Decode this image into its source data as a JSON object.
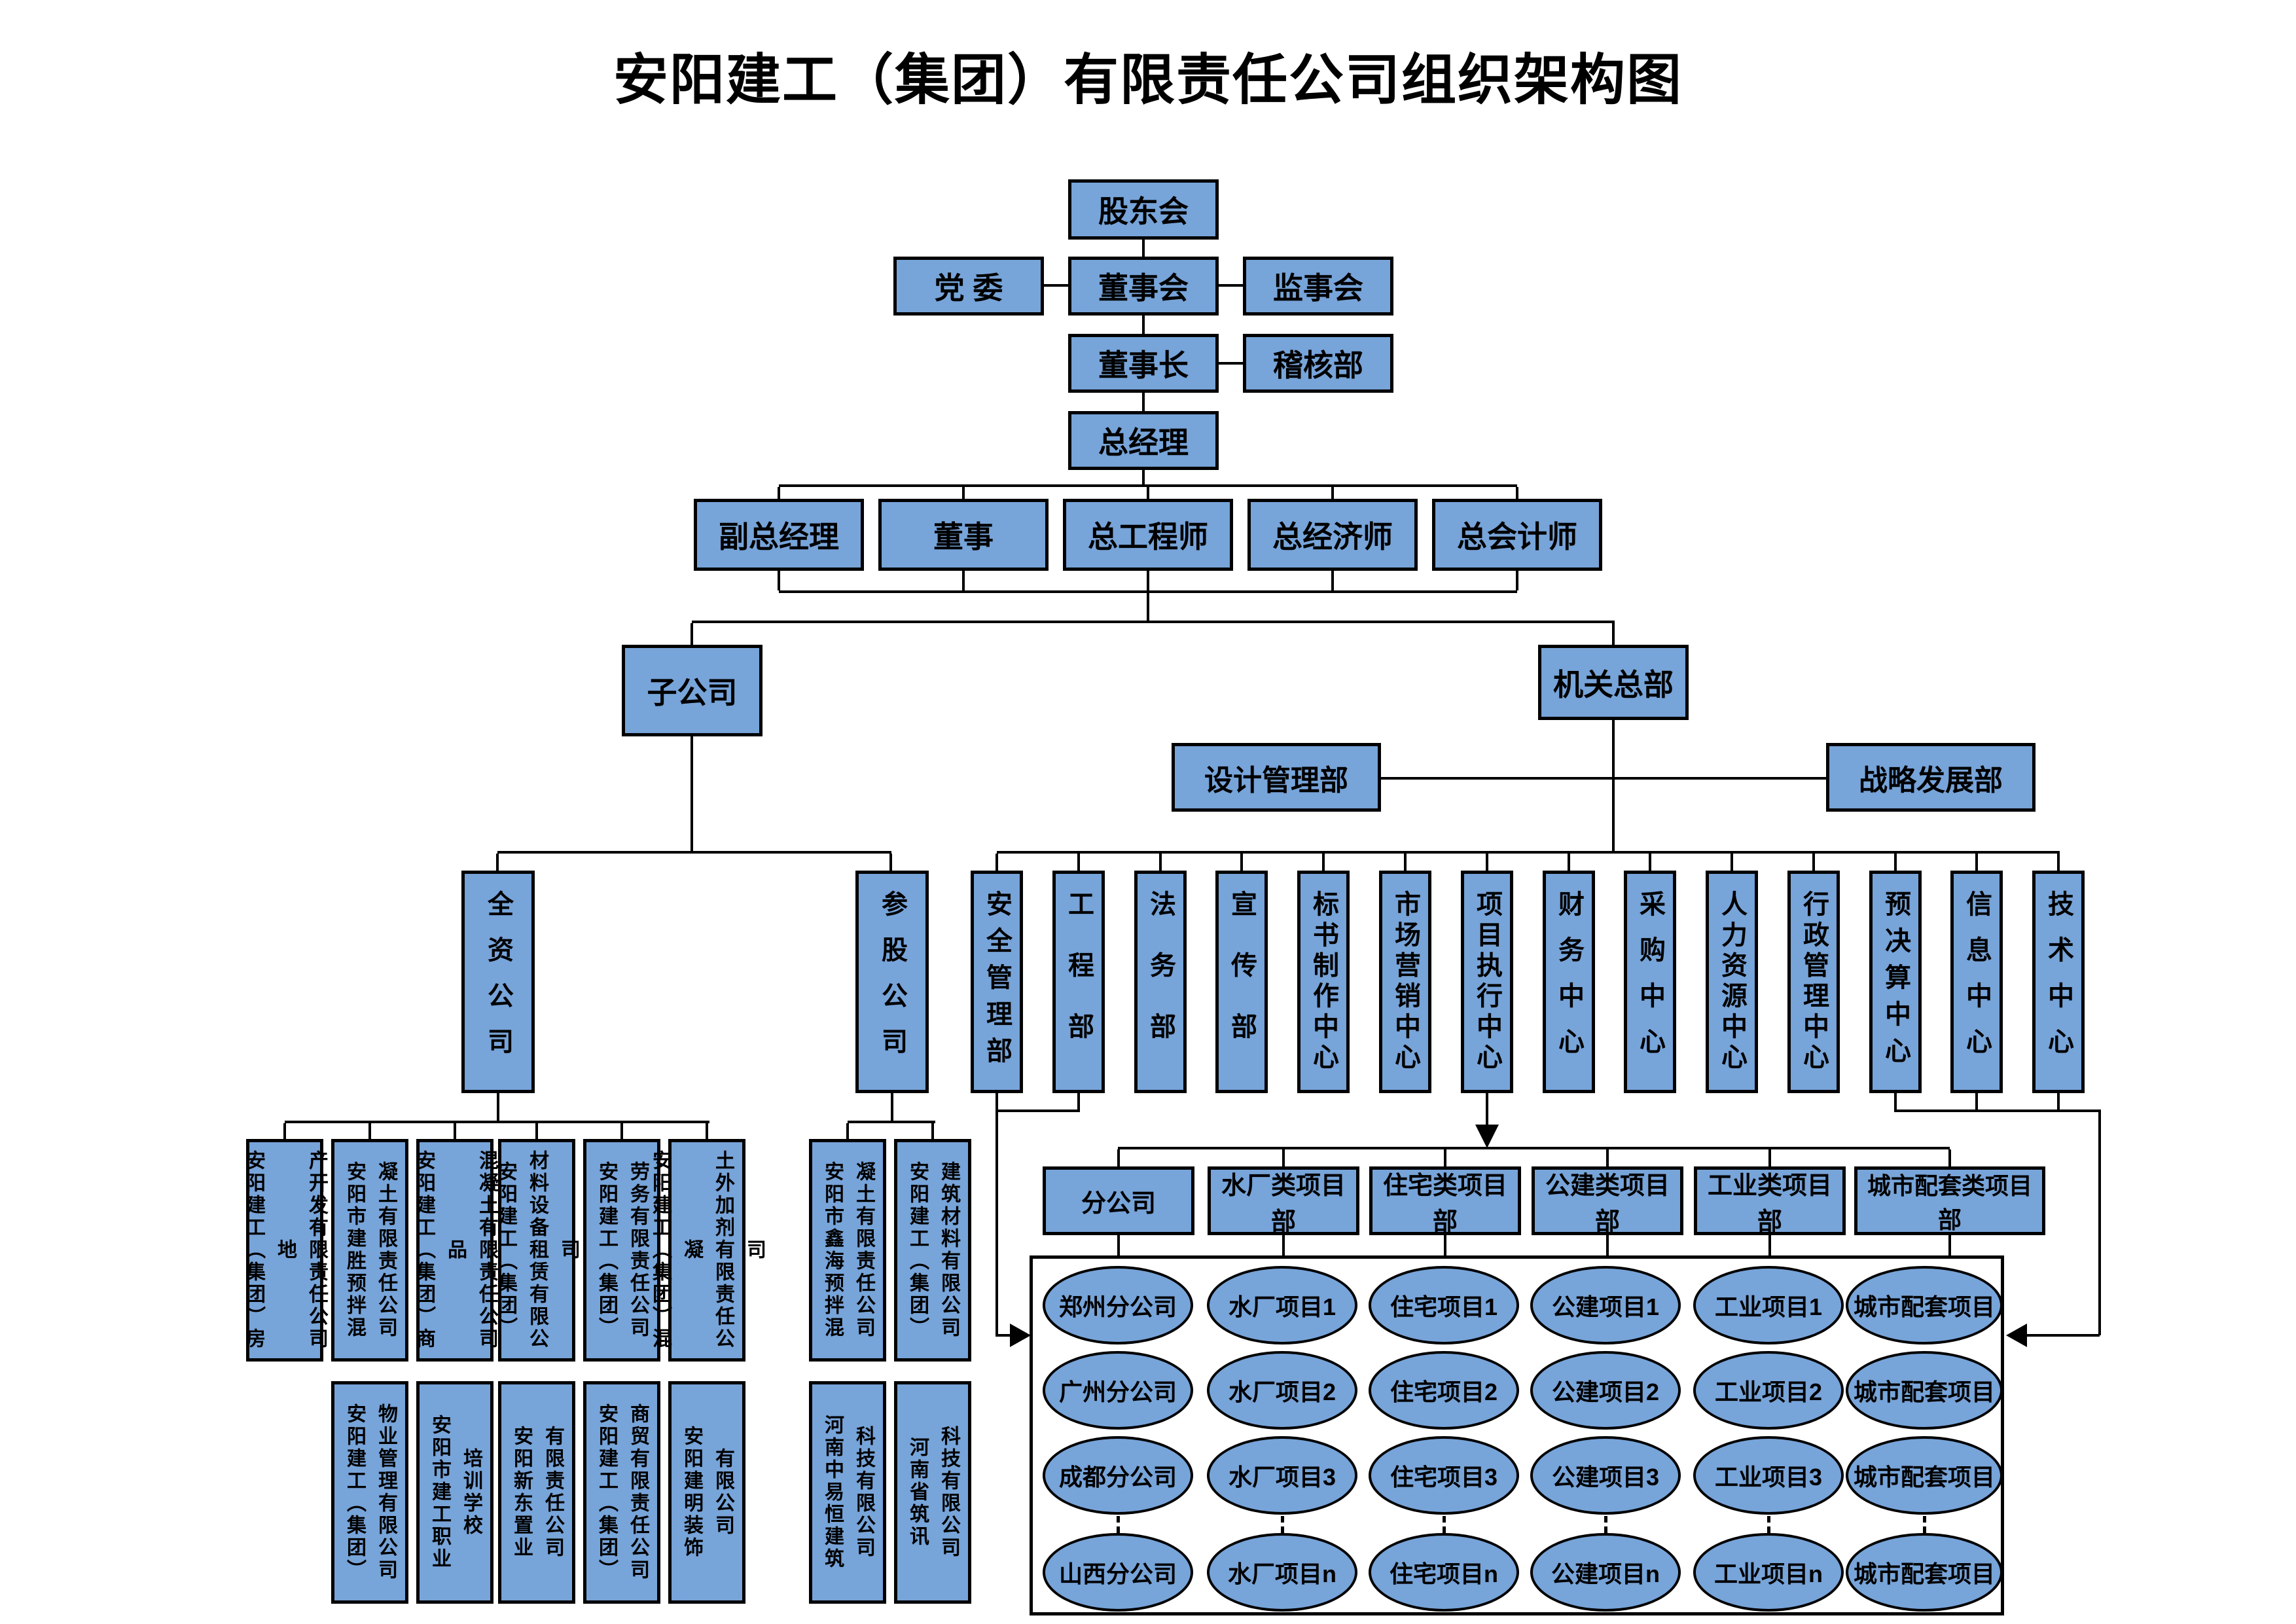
{
  "title": "安阳建工（集团）有限责任公司组织架构图",
  "colors": {
    "box_fill": "#77A4D9",
    "box_border": "#000000",
    "line": "#000000"
  },
  "top": {
    "shareholders": "股东会",
    "party": "党  委",
    "board": "董事会",
    "supervisory": "监事会",
    "chairman": "董事长",
    "audit": "稽核部",
    "general_manager": "总经理"
  },
  "executives": [
    "副总经理",
    "董事",
    "总工程师",
    "总经济师",
    "总会计师"
  ],
  "branches": {
    "subsidiary": "子公司",
    "hq": "机关总部",
    "design": "设计管理部",
    "strategy": "战略发展部"
  },
  "departments": [
    "安全管理部",
    "工程部",
    "法务部",
    "宣传部",
    "标书制作中心",
    "市场营销中心",
    "项目执行中心",
    "财务中心",
    "采购中心",
    "人力资源中心",
    "行政管理中心",
    "预决算中心",
    "信息中心",
    "技术中心"
  ],
  "wholly_owned": {
    "label": "全资公司",
    "row1": [
      "安阳建工（集团）房地\n产开发有限责任公司",
      "安阳市建胜预拌混\n凝土有限责任公司",
      "安阳建工（集团）商品\n混凝土有限责任公司",
      "安阳建工（集团）\n材料设备租赁有限公司",
      "安阳建工（集团）\n劳务有限责任公司",
      "安阳建工（集团）混凝\n土外加剂有限责任公司"
    ],
    "row2": [
      "安阳建工（集团）\n物业管理有限公司",
      "安阳市建工职业\n培训学校",
      "安阳新东置业\n有限责任公司",
      "安阳建工（集团）\n商贸有限责任公司",
      "安阳建明装饰\n有限公司"
    ]
  },
  "invested": {
    "label": "参股公司",
    "row1": [
      "安阳市鑫海预拌混\n凝土有限责任公司",
      "安阳建工（集团）\n建筑材料有限公司"
    ],
    "row2": [
      "河南中易恒建筑\n科技有限公司",
      "河南省筑讯\n科技有限公司"
    ]
  },
  "projects": {
    "headers": [
      "分公司",
      "水厂类项目部",
      "住宅类项目部",
      "公建类项目部",
      "工业类项目部",
      "城市配套类项目部"
    ],
    "rows": [
      [
        "郑州分公司",
        "水厂项目1",
        "住宅项目1",
        "公建项目1",
        "工业项目1",
        "城市配套项目"
      ],
      [
        "广州分公司",
        "水厂项目2",
        "住宅项目2",
        "公建项目2",
        "工业项目2",
        "城市配套项目"
      ],
      [
        "成都分公司",
        "水厂项目3",
        "住宅项目3",
        "公建项目3",
        "工业项目3",
        "城市配套项目"
      ],
      [
        "山西分公司",
        "水厂项目n",
        "住宅项目n",
        "公建项目n",
        "工业项目n",
        "城市配套项目"
      ]
    ]
  }
}
